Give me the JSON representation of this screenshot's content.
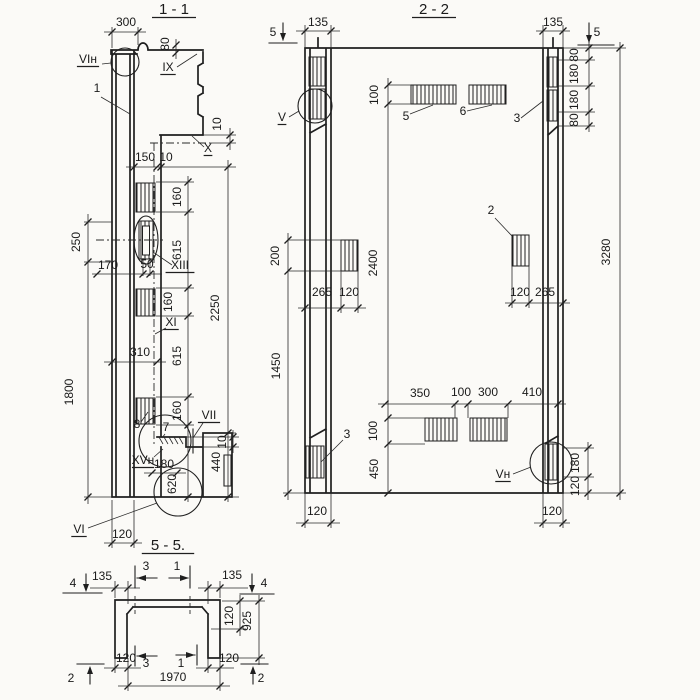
{
  "colors": {
    "ink": "#1f1f1f",
    "paper": "#fbfaf7"
  },
  "sections": {
    "section_1_1": "1 - 1",
    "section_2_2": "2 - 2",
    "section_5_5": "5 - 5."
  },
  "texts": [
    {
      "t": "1 - 1",
      "x": 174,
      "y": 14,
      "s": 15,
      "u": 1,
      "n": "title-section-1-1"
    },
    {
      "t": "300",
      "x": 126,
      "y": 26,
      "n": "dim-300-top"
    },
    {
      "t": "80",
      "x": 169,
      "y": 44,
      "r": 1,
      "n": "dim-80-top"
    },
    {
      "t": "VIн",
      "x": 88,
      "y": 63,
      "u": 1,
      "n": "label-VIn"
    },
    {
      "t": "1",
      "x": 97,
      "y": 92,
      "n": "leader-1"
    },
    {
      "t": "IX",
      "x": 168,
      "y": 71,
      "u": 1,
      "n": "label-IX"
    },
    {
      "t": "10",
      "x": 221,
      "y": 124,
      "r": 1,
      "n": "dim-10-step"
    },
    {
      "t": "X",
      "x": 208,
      "y": 152,
      "u": 1,
      "n": "label-X"
    },
    {
      "t": "150",
      "x": 145,
      "y": 161,
      "n": "dim-150"
    },
    {
      "t": "10",
      "x": 166,
      "y": 161,
      "n": "dim-10-gap"
    },
    {
      "t": "160",
      "x": 181,
      "y": 197,
      "r": 1,
      "n": "dim-160-a"
    },
    {
      "t": "615",
      "x": 181,
      "y": 250,
      "r": 1,
      "n": "dim-615-a"
    },
    {
      "t": "160",
      "x": 172,
      "y": 302,
      "r": 1,
      "n": "dim-160-b"
    },
    {
      "t": "615",
      "x": 181,
      "y": 356,
      "r": 1,
      "n": "dim-615-b"
    },
    {
      "t": "160",
      "x": 181,
      "y": 411,
      "r": 1,
      "n": "dim-160-c"
    },
    {
      "t": "620",
      "x": 176,
      "y": 484,
      "r": 1,
      "n": "dim-620"
    },
    {
      "t": "2250",
      "x": 219,
      "y": 308,
      "r": 1,
      "n": "dim-2250"
    },
    {
      "t": "250",
      "x": 80,
      "y": 242,
      "r": 1,
      "n": "dim-250"
    },
    {
      "t": "1800",
      "x": 73,
      "y": 392,
      "r": 1,
      "n": "dim-1800"
    },
    {
      "t": "170",
      "x": 108,
      "y": 269,
      "n": "dim-170"
    },
    {
      "t": "50",
      "x": 147,
      "y": 268,
      "n": "dim-50"
    },
    {
      "t": "XIII",
      "x": 180,
      "y": 269,
      "u": 1,
      "n": "label-XIII"
    },
    {
      "t": "XI",
      "x": 171,
      "y": 326,
      "u": 1,
      "n": "label-XI"
    },
    {
      "t": "310",
      "x": 140,
      "y": 356,
      "n": "dim-310"
    },
    {
      "t": "8",
      "x": 137,
      "y": 428,
      "n": "leader-8"
    },
    {
      "t": "7",
      "x": 166,
      "y": 431,
      "n": "leader-7"
    },
    {
      "t": "VII",
      "x": 209,
      "y": 419,
      "u": 1,
      "n": "label-VII"
    },
    {
      "t": "10",
      "x": 226,
      "y": 442,
      "r": 1,
      "n": "dim-10-shelf"
    },
    {
      "t": "XVн",
      "x": 143,
      "y": 464,
      "u": 1,
      "n": "label-XVn"
    },
    {
      "t": "180",
      "x": 164,
      "y": 468,
      "n": "dim-180-foot"
    },
    {
      "t": "440",
      "x": 220,
      "y": 462,
      "r": 1,
      "n": "dim-440"
    },
    {
      "t": "VI",
      "x": 79,
      "y": 533,
      "u": 1,
      "n": "label-VI"
    },
    {
      "t": "120",
      "x": 122,
      "y": 538,
      "n": "dim-120-base-11"
    },
    {
      "t": "2 - 2",
      "x": 434,
      "y": 14,
      "s": 15,
      "u": 1,
      "n": "title-section-2-2"
    },
    {
      "t": "5",
      "x": 273,
      "y": 36,
      "n": "marker-5-left"
    },
    {
      "t": "135",
      "x": 318,
      "y": 26,
      "n": "dim-135-left"
    },
    {
      "t": "135",
      "x": 553,
      "y": 26,
      "n": "dim-135-right"
    },
    {
      "t": "5",
      "x": 597,
      "y": 36,
      "n": "marker-5-right"
    },
    {
      "t": "80",
      "x": 578,
      "y": 55,
      "r": 1,
      "n": "dim-80-tr-a"
    },
    {
      "t": "180",
      "x": 578,
      "y": 74,
      "r": 1,
      "n": "dim-180-tr-a"
    },
    {
      "t": "180",
      "x": 578,
      "y": 100,
      "r": 1,
      "n": "dim-180-tr-b"
    },
    {
      "t": "80",
      "x": 578,
      "y": 120,
      "r": 1,
      "n": "dim-80-tr-b"
    },
    {
      "t": "3280",
      "x": 610,
      "y": 252,
      "r": 1,
      "n": "dim-3280"
    },
    {
      "t": "3",
      "x": 517,
      "y": 122,
      "n": "leader-3-top"
    },
    {
      "t": "5",
      "x": 406,
      "y": 120,
      "n": "leader-5"
    },
    {
      "t": "6",
      "x": 463,
      "y": 115,
      "n": "leader-6"
    },
    {
      "t": "100",
      "x": 378,
      "y": 95,
      "r": 1,
      "n": "dim-100-top"
    },
    {
      "t": "2400",
      "x": 377,
      "y": 263,
      "r": 1,
      "n": "dim-2400"
    },
    {
      "t": "2",
      "x": 491,
      "y": 214,
      "n": "leader-2"
    },
    {
      "t": "120",
      "x": 520,
      "y": 296,
      "n": "dim-120-rm"
    },
    {
      "t": "265",
      "x": 545,
      "y": 296,
      "n": "dim-265-rm"
    },
    {
      "t": "265",
      "x": 322,
      "y": 296,
      "n": "dim-265-lm"
    },
    {
      "t": "120",
      "x": 349,
      "y": 296,
      "n": "dim-120-lm"
    },
    {
      "t": "200",
      "x": 279,
      "y": 256,
      "r": 1,
      "n": "dim-200"
    },
    {
      "t": "1450",
      "x": 280,
      "y": 366,
      "r": 1,
      "n": "dim-1450"
    },
    {
      "t": "350",
      "x": 420,
      "y": 397,
      "n": "dim-350"
    },
    {
      "t": "100",
      "x": 461,
      "y": 396,
      "n": "dim-100-bh"
    },
    {
      "t": "300",
      "x": 488,
      "y": 396,
      "n": "dim-300-b"
    },
    {
      "t": "410",
      "x": 532,
      "y": 396,
      "n": "dim-410"
    },
    {
      "t": "100",
      "x": 377,
      "y": 431,
      "r": 1,
      "n": "dim-100-bv"
    },
    {
      "t": "450",
      "x": 378,
      "y": 469,
      "r": 1,
      "n": "dim-450"
    },
    {
      "t": "3",
      "x": 347,
      "y": 438,
      "n": "leader-3-bottom"
    },
    {
      "t": "Vн",
      "x": 503,
      "y": 478,
      "u": 1,
      "n": "label-Vn"
    },
    {
      "t": "180",
      "x": 579,
      "y": 463,
      "r": 1,
      "n": "dim-180-br"
    },
    {
      "t": "120",
      "x": 579,
      "y": 486,
      "r": 1,
      "n": "dim-120-br"
    },
    {
      "t": "120",
      "x": 317,
      "y": 515,
      "n": "dim-120-bl-base"
    },
    {
      "t": "120",
      "x": 552,
      "y": 515,
      "n": "dim-120-br-base"
    },
    {
      "t": "V",
      "x": 282,
      "y": 121,
      "u": 1,
      "n": "label-V"
    },
    {
      "t": "5 - 5.",
      "x": 168,
      "y": 550,
      "s": 15,
      "u": 1,
      "n": "title-section-5-5"
    },
    {
      "t": "4",
      "x": 73,
      "y": 587,
      "n": "marker-4-left"
    },
    {
      "t": "135",
      "x": 102,
      "y": 580,
      "n": "dim-135-55l"
    },
    {
      "t": "3",
      "x": 146,
      "y": 570,
      "n": "marker-3-top"
    },
    {
      "t": "1",
      "x": 177,
      "y": 570,
      "n": "marker-1-top"
    },
    {
      "t": "135",
      "x": 232,
      "y": 579,
      "n": "dim-135-55r"
    },
    {
      "t": "4",
      "x": 264,
      "y": 587,
      "n": "marker-4-right"
    },
    {
      "t": "120",
      "x": 233,
      "y": 616,
      "r": 1,
      "n": "dim-120-flange"
    },
    {
      "t": "925",
      "x": 251,
      "y": 621,
      "r": 1,
      "n": "dim-925"
    },
    {
      "t": "120",
      "x": 126,
      "y": 662,
      "n": "dim-120-leg-l"
    },
    {
      "t": "3",
      "x": 146,
      "y": 667,
      "n": "marker-3-bottom"
    },
    {
      "t": "1",
      "x": 181,
      "y": 667,
      "n": "marker-1-bottom"
    },
    {
      "t": "120",
      "x": 229,
      "y": 662,
      "n": "dim-120-leg-r"
    },
    {
      "t": "1970",
      "x": 173,
      "y": 681,
      "n": "dim-1970"
    },
    {
      "t": "2",
      "x": 71,
      "y": 682,
      "n": "marker-2-left"
    },
    {
      "t": "2",
      "x": 261,
      "y": 682,
      "n": "marker-2-right"
    }
  ]
}
